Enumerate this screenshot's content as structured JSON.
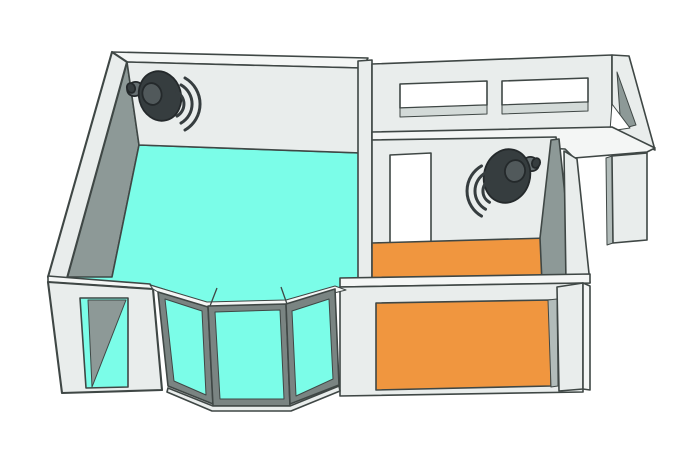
{
  "colors": {
    "background": "#ffffff",
    "outline": "#3f4745",
    "wall_face": "#e9edec",
    "wall_top": "#f4f6f5",
    "wall_shadow": "#8d9997",
    "wall_shadow_light": "#b2bcba",
    "window_sill": "#d3dad8",
    "opening_white": "#ffffff",
    "bay_frame": "#7a8482",
    "floor_left_room": "#7bfde8",
    "floor_right_room": "#f0963f",
    "speaker_body": "#363d3f",
    "speaker_cap": "#51595b",
    "speaker_mount": "#677072",
    "speaker_outline": "#24292b"
  },
  "scene": {
    "speaker_icon": "speaker-with-sound-waves",
    "speaker_count": 2,
    "waves_per_speaker": 3,
    "left_room": {
      "floor_color": "#7bfde8",
      "features": [
        "corner-speaker",
        "bay-window-3-panes",
        "front-wall-opening"
      ]
    },
    "right_room": {
      "floor_color": "#f0963f",
      "features": [
        "corner-speaker",
        "door-opening",
        "front-wall-opening"
      ]
    },
    "back_corridor": {
      "window_count": 2
    },
    "entry": {
      "doorway_count": 1
    }
  }
}
